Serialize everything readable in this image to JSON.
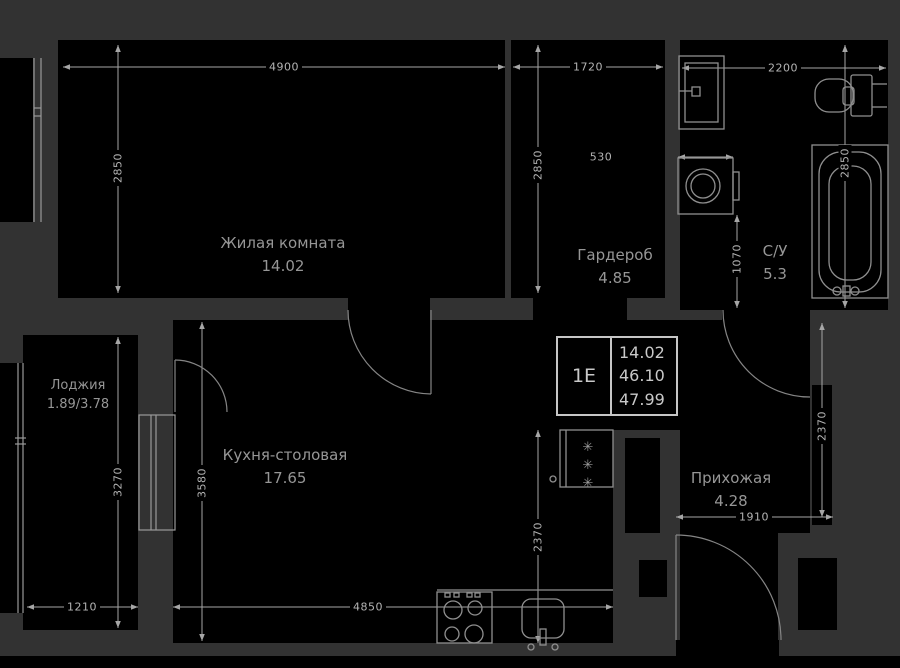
{
  "plan": {
    "unit_info": {
      "unit_label": "1Е",
      "room_area": "14.02",
      "living_area": "46.10",
      "total_area": "47.99"
    },
    "rooms": [
      {
        "name": "Жилая комната",
        "area": "14.02"
      },
      {
        "name": "Гардероб",
        "area": "4.85"
      },
      {
        "name": "С/У",
        "area": "5.3"
      },
      {
        "name": "Лоджия",
        "area": "1.89/3.78"
      },
      {
        "name": "Кухня-столовая",
        "area": "17.65"
      },
      {
        "name": "Прихожая",
        "area": "4.28"
      }
    ],
    "dimensions": {
      "living_width": "4900",
      "living_depth": "2850",
      "wardrobe_width": "1720",
      "wardrobe_depth": "2850",
      "bathroom_width": "2200",
      "bathroom_depth": "2850",
      "washer_width": "530",
      "washer_clearance": "1070",
      "hallway_depth": "2370",
      "hallway_width": "1910",
      "kitchen_width": "4850",
      "kitchen_depth": "3580",
      "kitchen_lower_depth": "2370",
      "loggia_width": "1210",
      "loggia_depth": "3270"
    },
    "symbols": {
      "fridge_mark": "✳"
    },
    "colors": {
      "canvas": "#323232",
      "room_fill": "#000000",
      "dimension_line": "#a6a6a6",
      "label_text": "#969696",
      "info_border": "#c6c6c6"
    }
  }
}
